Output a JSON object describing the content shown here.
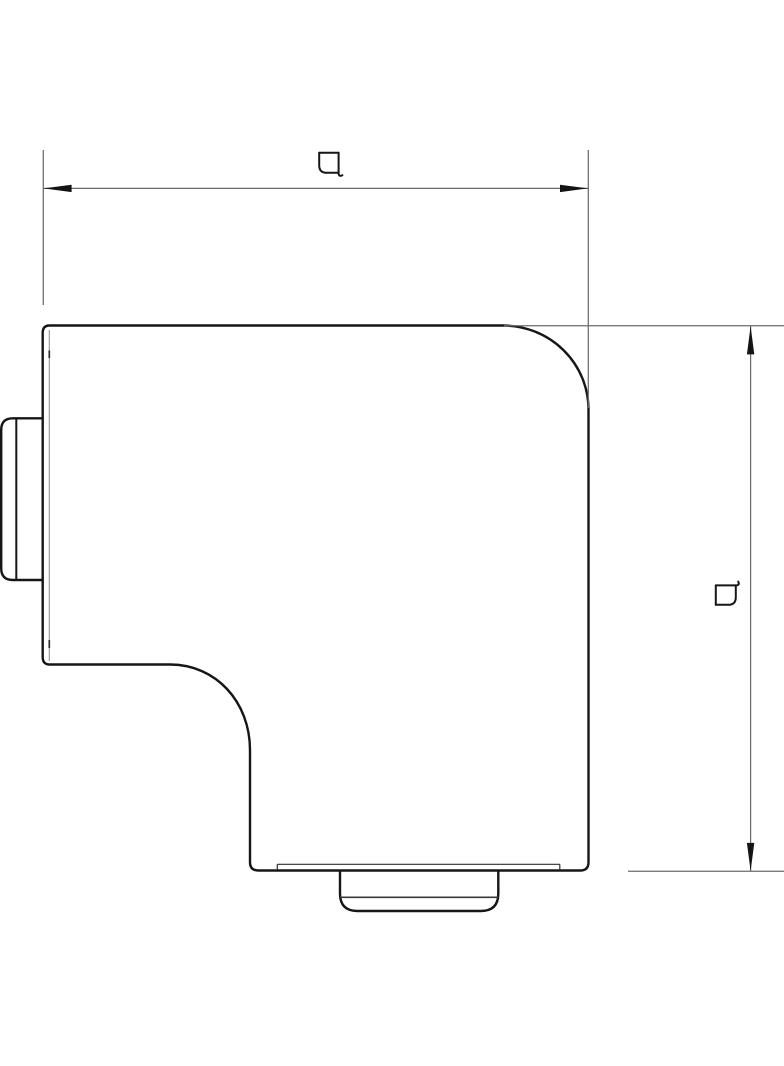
{
  "page": {
    "background": "#ffffff"
  },
  "colors": {
    "background": "#ffffff",
    "outline": "#161616",
    "dimension": "#6b6b6b",
    "arrow": "#141414",
    "cover_line": "#929292",
    "cover_tick": "#2e2e2e",
    "inner_face_line": "#3a3a3a"
  },
  "dimensions": {
    "horizontal": {
      "label": "a"
    },
    "vertical": {
      "label": "a"
    }
  }
}
